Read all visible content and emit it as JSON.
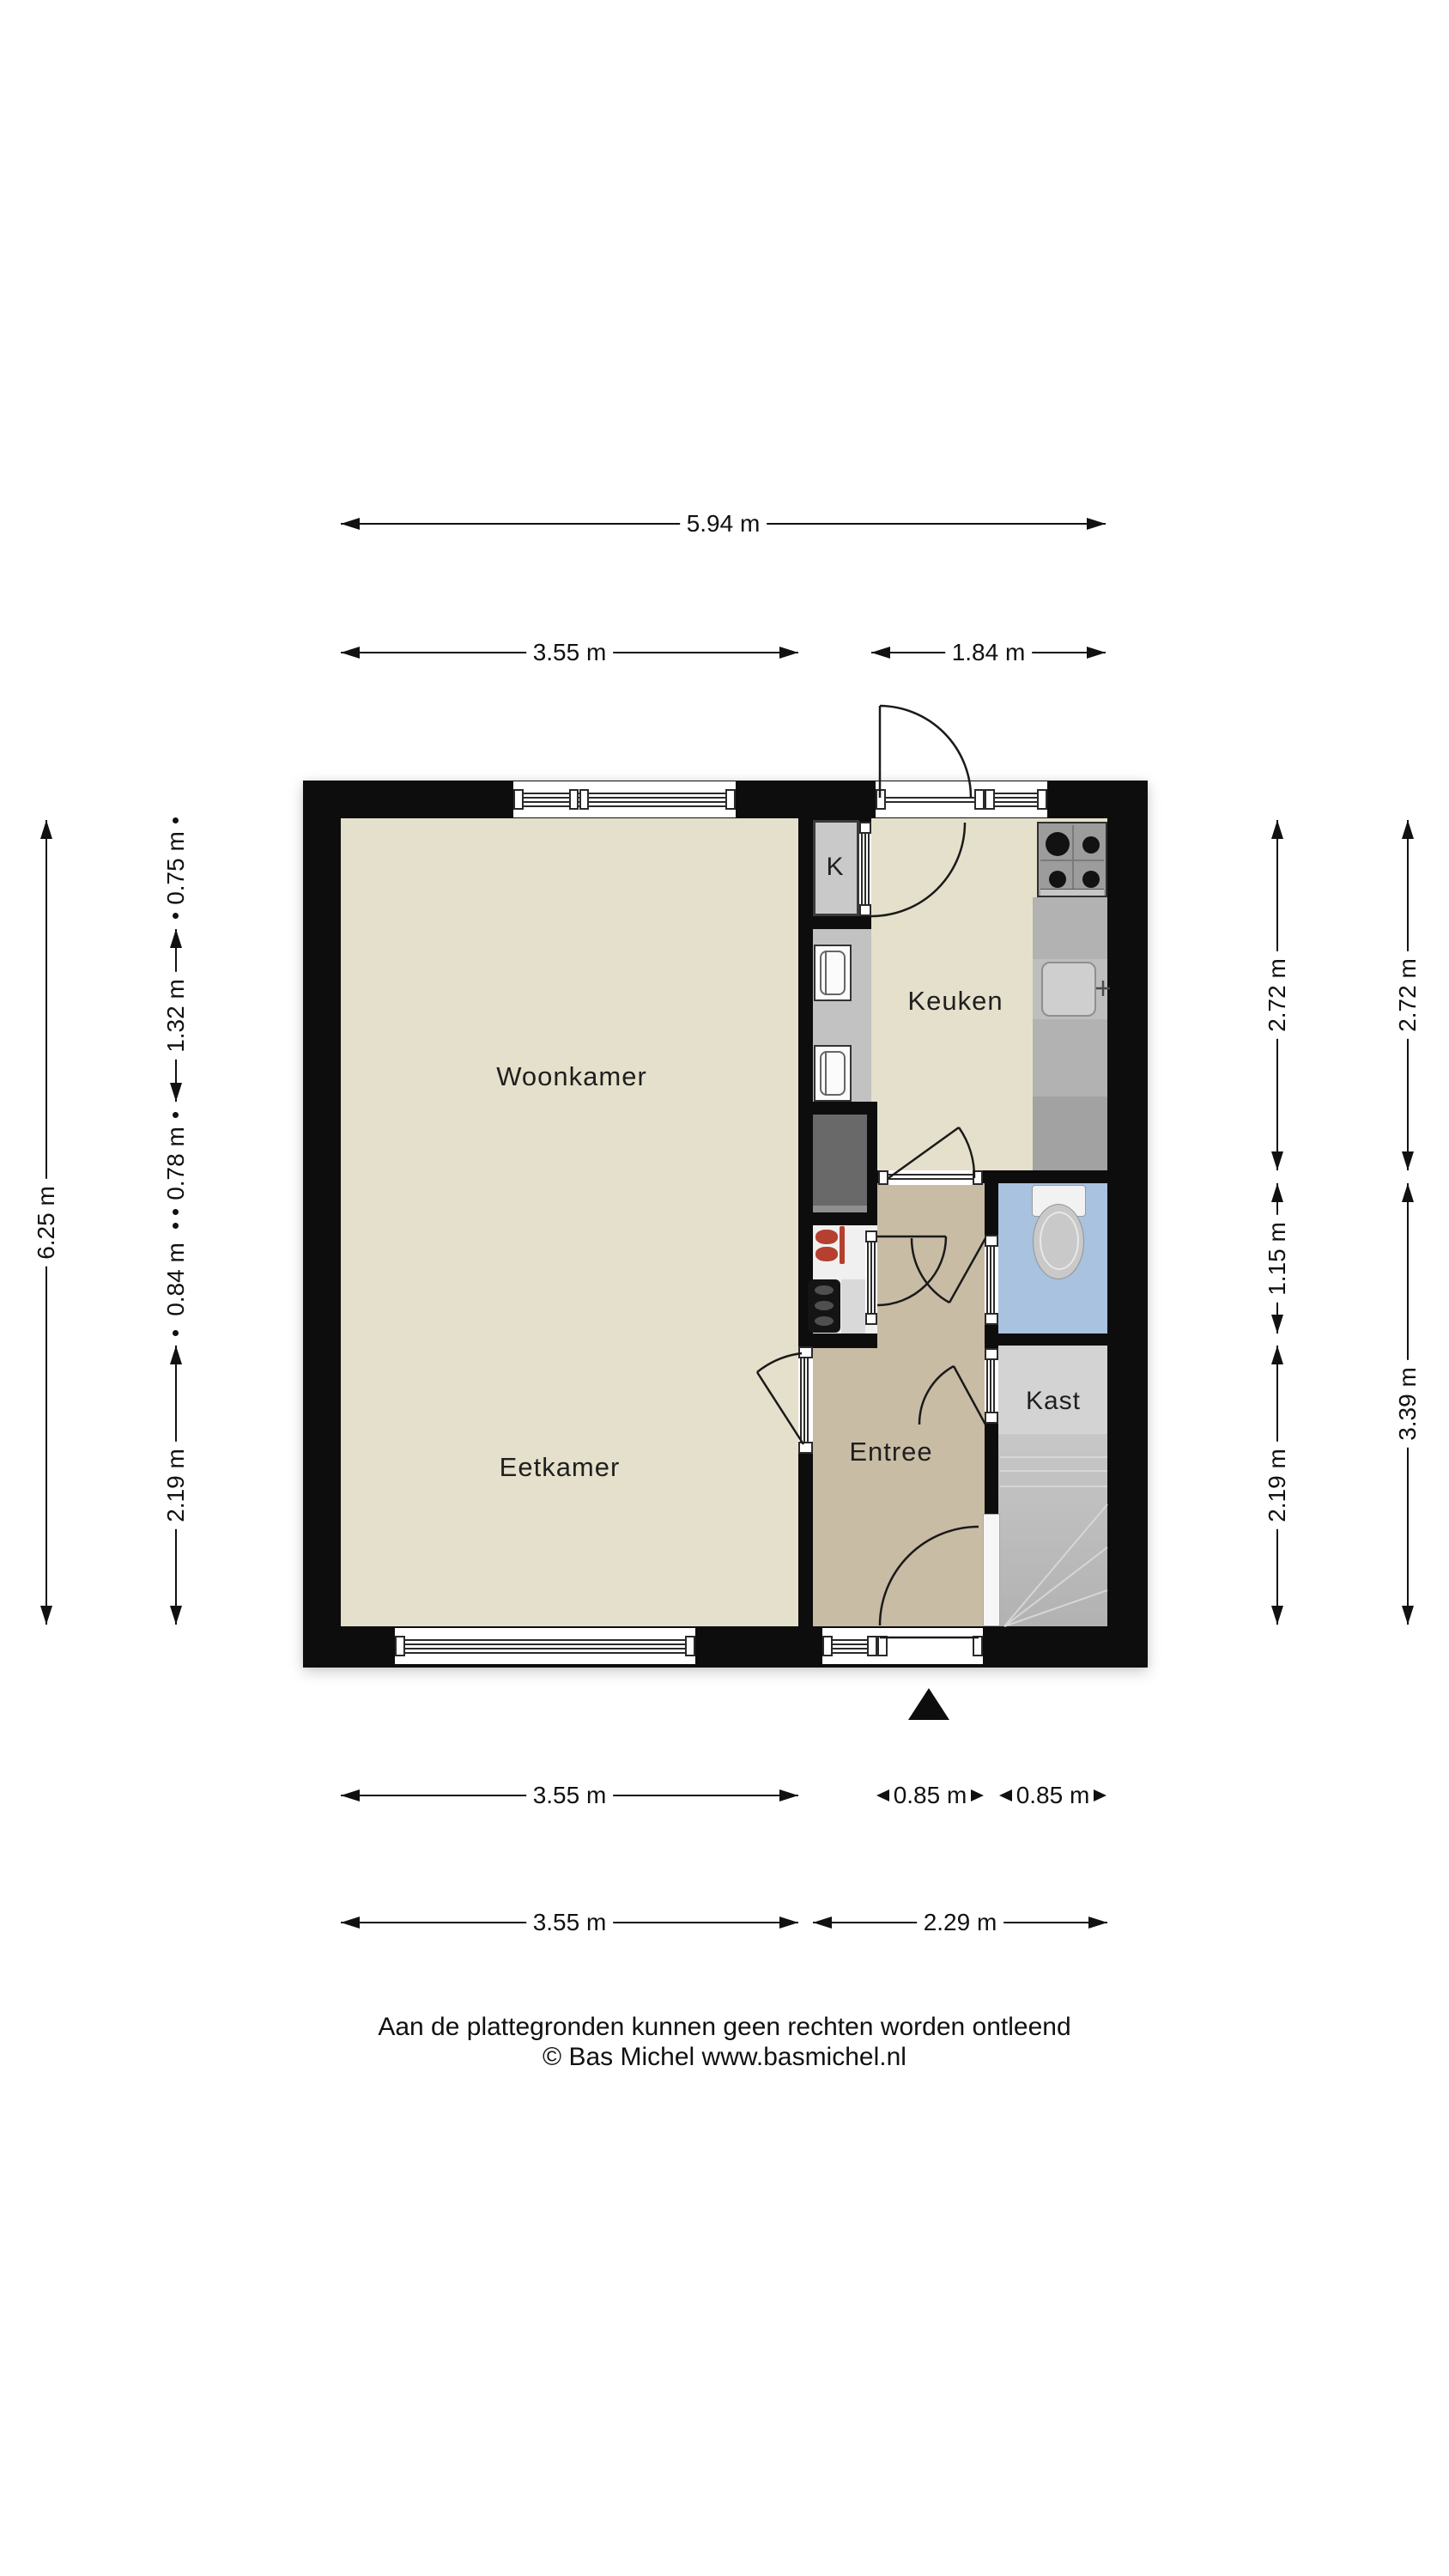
{
  "plan": {
    "rooms": {
      "woonkamer": "Woonkamer",
      "eetkamer": "Eetkamer",
      "keuken": "Keuken",
      "entree": "Entree",
      "kast": "Kast",
      "meterkast": "K"
    },
    "colors": {
      "wall": "#0d0d0d",
      "floor_living": "#e5e0cb",
      "floor_entree": "#c9bca5",
      "floor_toilet": "#a8c2e0",
      "floor_kast": "#d3d3d3",
      "floor_closet": "#c9c9c9",
      "counter": "#b2b2b2",
      "stairs": "#bdbdbd",
      "duct": "#696969",
      "boiler_accent": "#b5402f"
    }
  },
  "dimensions": {
    "top_total": "5.94 m",
    "top_left": "3.55 m",
    "top_right": "1.84 m",
    "left_total": "6.25 m",
    "left_segments": [
      "0.75 m",
      "1.32 m",
      "0.78 m",
      "0.84 m",
      "2.19 m"
    ],
    "right_inner": [
      "2.72 m",
      "1.15 m",
      "2.19 m"
    ],
    "right_outer": [
      "2.72 m",
      "3.39 m"
    ],
    "bottom_row1": [
      "3.55 m",
      "0.85 m",
      "0.85 m"
    ],
    "bottom_row2": [
      "3.55 m",
      "2.29 m"
    ]
  },
  "footer": {
    "line1": "Aan de plattegronden kunnen geen rechten worden ontleend",
    "line2": "© Bas Michel www.basmichel.nl"
  }
}
